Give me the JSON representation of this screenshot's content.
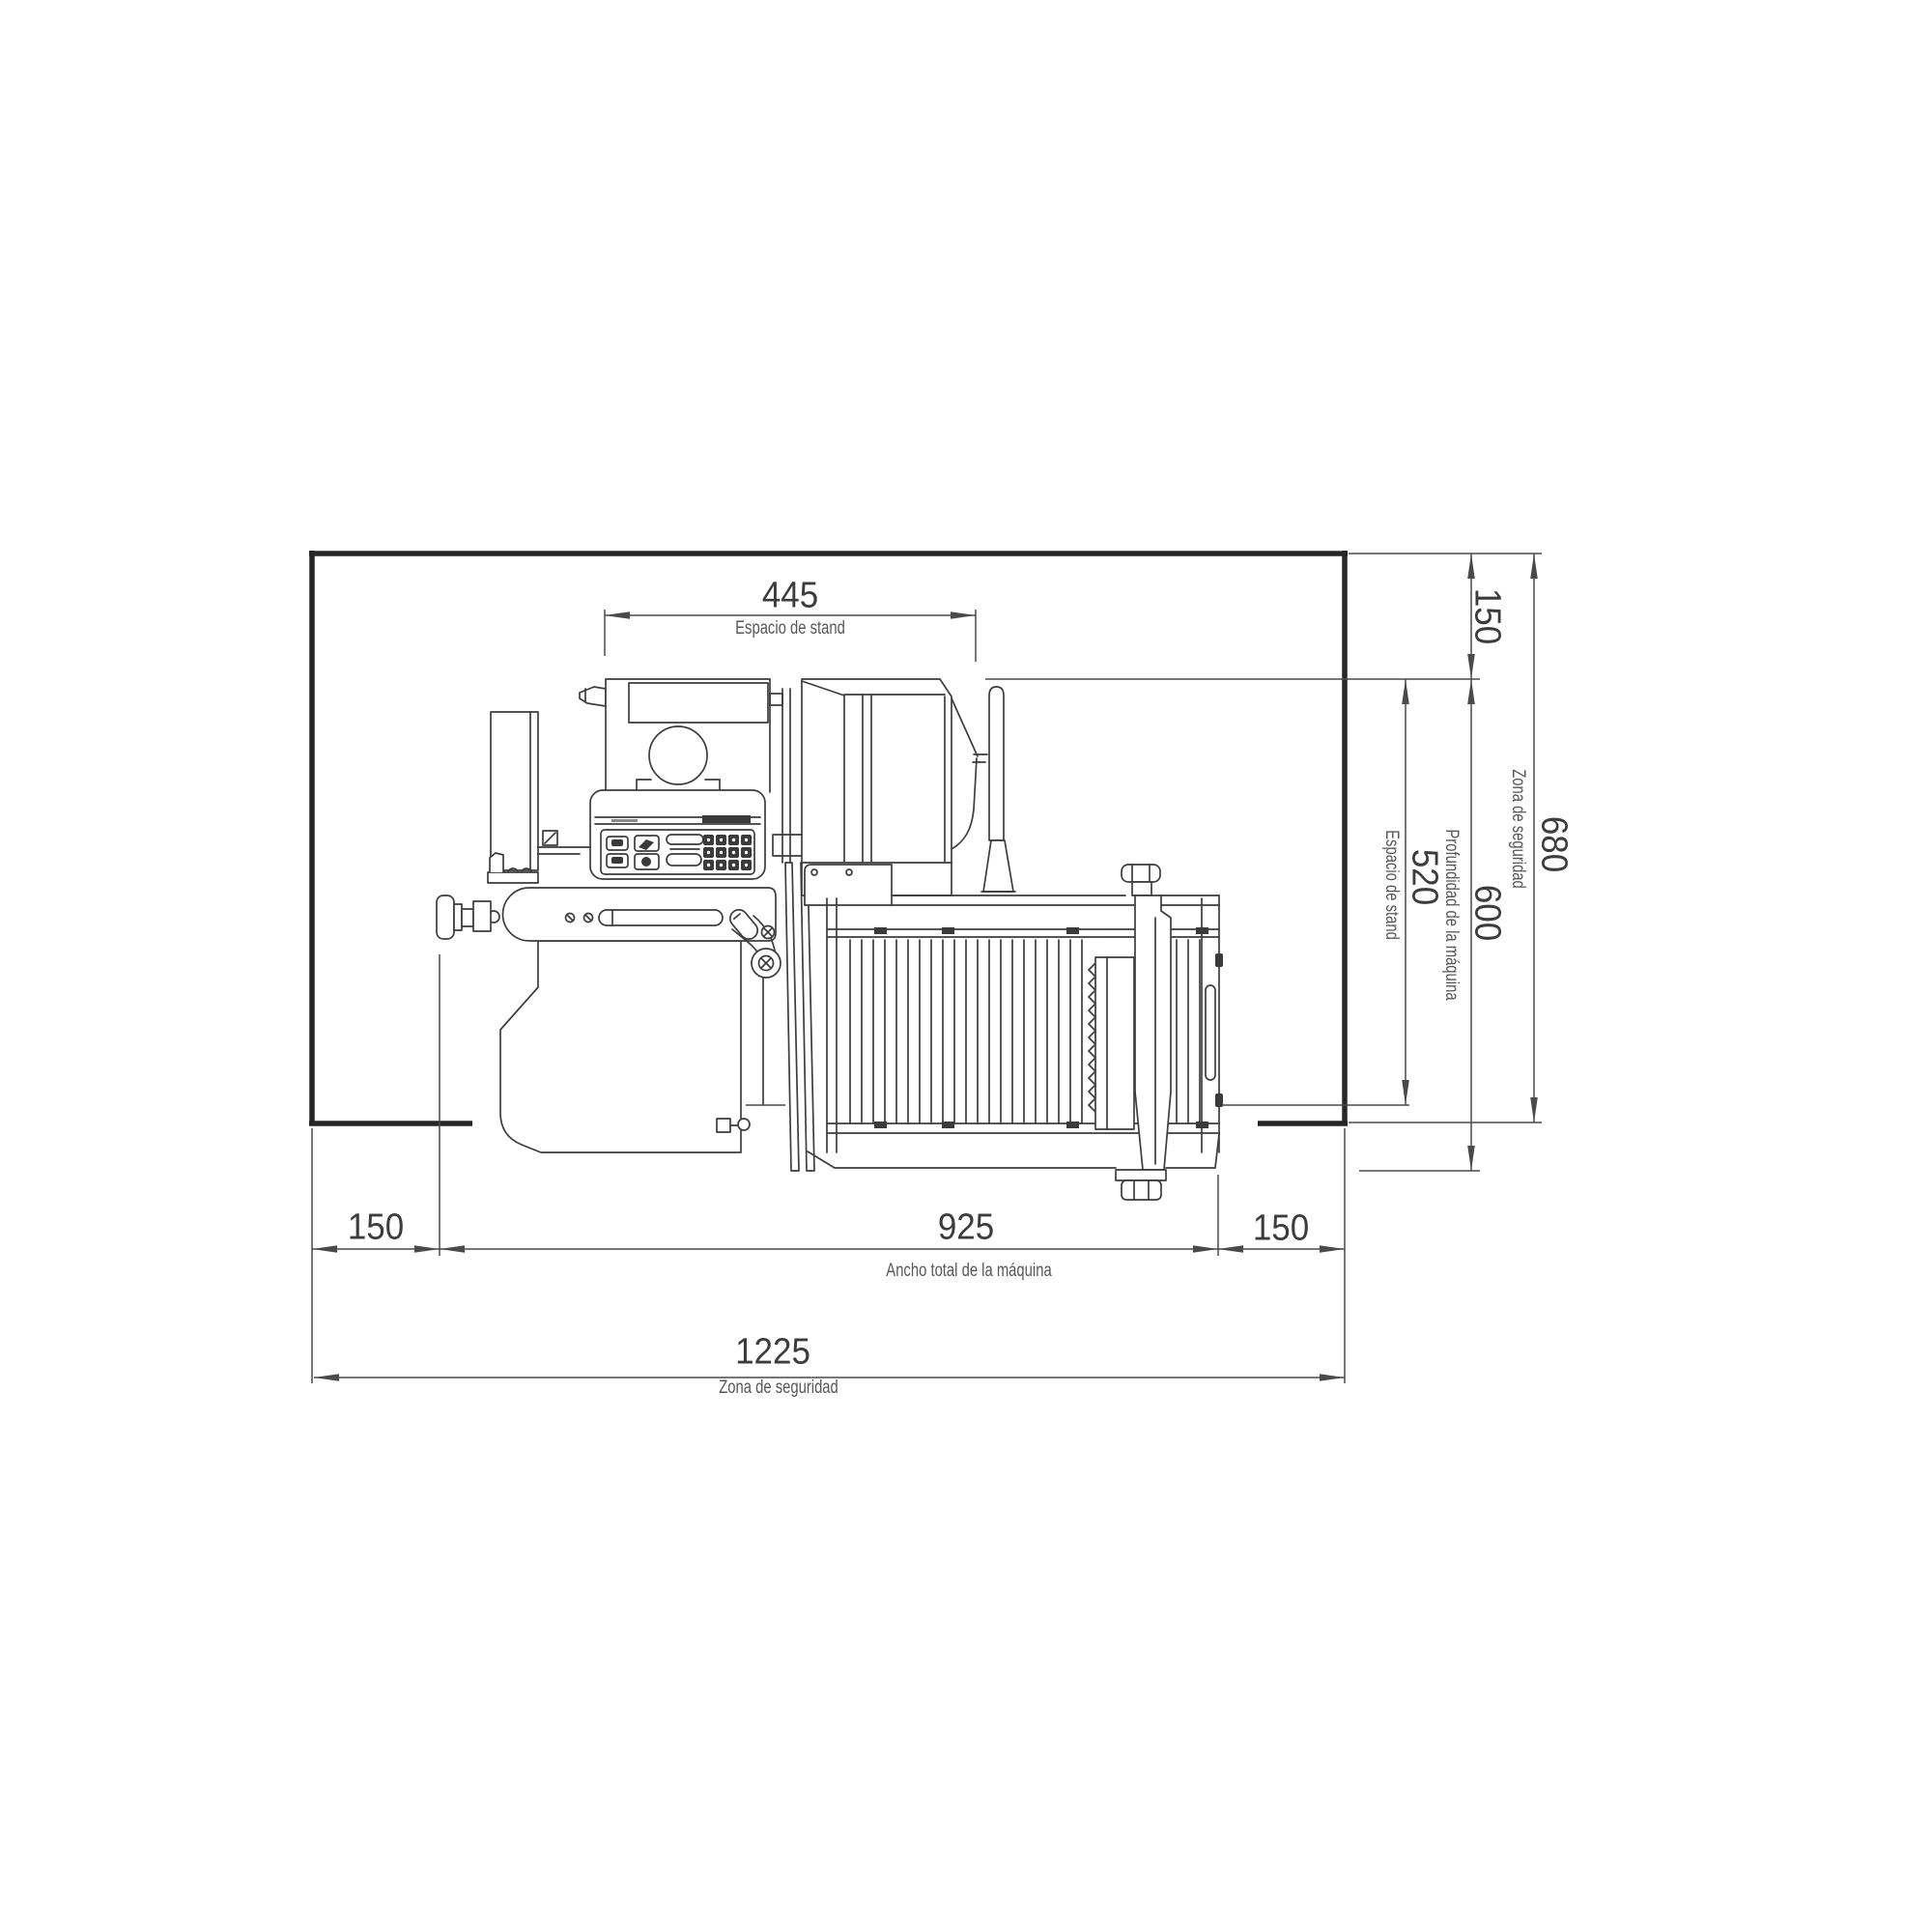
{
  "drawing": {
    "top_dim": {
      "value": "445",
      "label": "Espacio de stand"
    },
    "right_dims": {
      "top_margin": {
        "value": "150"
      },
      "safety_depth": {
        "value": "680",
        "label": "Zona de seguridad"
      },
      "machine_depth": {
        "value": "600",
        "label": "Profundidad de la máquina"
      },
      "stand_depth": {
        "value": "520",
        "label": "Espacio de stand"
      }
    },
    "bottom_dims": {
      "left_margin": {
        "value": "150"
      },
      "machine_width": {
        "value": "925",
        "label": "Ancho total de la máquina"
      },
      "right_margin": {
        "value": "150"
      },
      "safety_width": {
        "value": "1225",
        "label": "Zona de seguridad"
      }
    },
    "colors": {
      "ink": "#3d3d3d",
      "dim_line": "#4a4a4a",
      "border": "#262626"
    }
  }
}
